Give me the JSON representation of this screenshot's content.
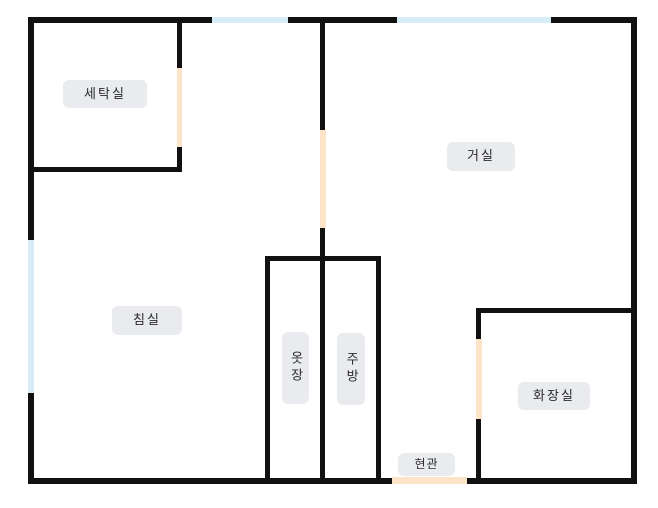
{
  "colors": {
    "background": "#ffffff",
    "wall": "#111111",
    "window": "#d6edf8",
    "door": "#fbe4c8",
    "label_bg": "#e9ebee",
    "label_text": "#2b2b2b"
  },
  "floorplan": {
    "title": "apartment-floor-plan",
    "walls": [
      {
        "x": 28,
        "y": 17,
        "w": 185,
        "h": 6
      },
      {
        "x": 287,
        "y": 17,
        "w": 111,
        "h": 6
      },
      {
        "x": 550,
        "y": 17,
        "w": 87,
        "h": 6
      },
      {
        "x": 28,
        "y": 17,
        "w": 6,
        "h": 224
      },
      {
        "x": 28,
        "y": 392,
        "w": 6,
        "h": 92
      },
      {
        "x": 631,
        "y": 17,
        "w": 6,
        "h": 467
      },
      {
        "x": 28,
        "y": 478,
        "w": 365,
        "h": 6
      },
      {
        "x": 466,
        "y": 478,
        "w": 171,
        "h": 6
      },
      {
        "x": 177,
        "y": 20,
        "w": 5,
        "h": 48
      },
      {
        "x": 177,
        "y": 146,
        "w": 5,
        "h": 26
      },
      {
        "x": 30,
        "y": 167,
        "w": 152,
        "h": 5
      },
      {
        "x": 320,
        "y": 20,
        "w": 5,
        "h": 110
      },
      {
        "x": 320,
        "y": 227,
        "w": 5,
        "h": 253
      },
      {
        "x": 265,
        "y": 256,
        "w": 115,
        "h": 5
      },
      {
        "x": 265,
        "y": 256,
        "w": 5,
        "h": 224
      },
      {
        "x": 376,
        "y": 256,
        "w": 5,
        "h": 224
      },
      {
        "x": 477,
        "y": 308,
        "w": 160,
        "h": 5
      },
      {
        "x": 476,
        "y": 308,
        "w": 5,
        "h": 32
      },
      {
        "x": 476,
        "y": 418,
        "w": 5,
        "h": 62
      }
    ],
    "windows": [
      {
        "x": 212,
        "y": 17,
        "w": 76,
        "h": 6
      },
      {
        "x": 397,
        "y": 17,
        "w": 154,
        "h": 6
      },
      {
        "x": 28,
        "y": 240,
        "w": 6,
        "h": 153
      }
    ],
    "doors": [
      {
        "x": 177,
        "y": 68,
        "w": 5,
        "h": 79
      },
      {
        "x": 320,
        "y": 130,
        "w": 6,
        "h": 98
      },
      {
        "x": 476,
        "y": 339,
        "w": 6,
        "h": 80
      },
      {
        "x": 392,
        "y": 477,
        "w": 75,
        "h": 7
      }
    ],
    "labels": [
      {
        "name": "laundry-room",
        "text": "세탁실",
        "x": 63,
        "y": 80,
        "w": 84,
        "h": 28,
        "vertical": false,
        "small": false
      },
      {
        "name": "living-room",
        "text": "거실",
        "x": 447,
        "y": 142,
        "w": 68,
        "h": 29,
        "vertical": false,
        "small": false
      },
      {
        "name": "bedroom",
        "text": "침실",
        "x": 112,
        "y": 306,
        "w": 70,
        "h": 29,
        "vertical": false,
        "small": false
      },
      {
        "name": "closet",
        "text": "옷장",
        "x": 282,
        "y": 332,
        "w": 27,
        "h": 72,
        "vertical": true,
        "small": false
      },
      {
        "name": "kitchen",
        "text": "주방",
        "x": 337,
        "y": 333,
        "w": 28,
        "h": 72,
        "vertical": true,
        "small": false
      },
      {
        "name": "bathroom",
        "text": "화장실",
        "x": 518,
        "y": 382,
        "w": 72,
        "h": 28,
        "vertical": false,
        "small": false
      },
      {
        "name": "entrance",
        "text": "현관",
        "x": 398,
        "y": 453,
        "w": 57,
        "h": 23,
        "vertical": false,
        "small": true
      }
    ]
  }
}
